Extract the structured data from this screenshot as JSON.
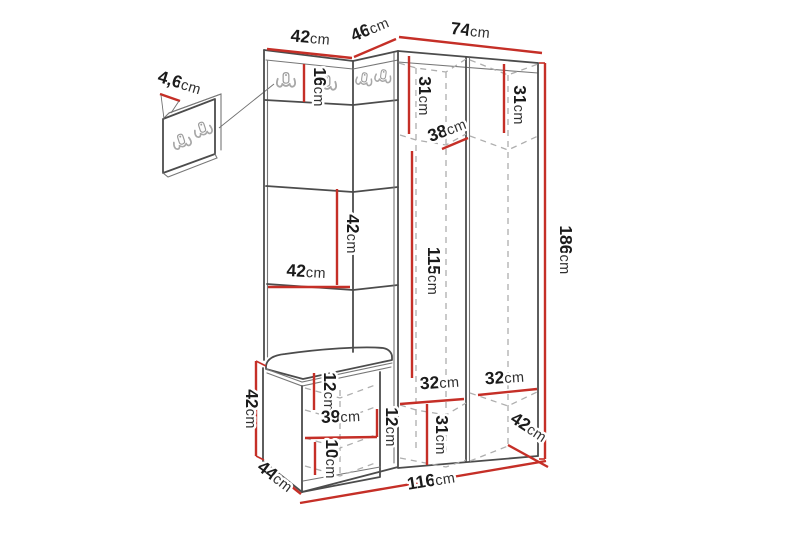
{
  "figure": {
    "kind": "furniture-dimension-diagram",
    "subject": "corner hallway unit with coat hooks, bench and wall hook panel"
  },
  "colors": {
    "background": "#ffffff",
    "dimension_red": "#c52f27",
    "outline": "#4c4c4c",
    "hidden_edge": "#aeaeae",
    "hook_gray": "#a8a8a8",
    "label_text": "#1b1b1b"
  },
  "icons": {
    "hook": "double-coat-hook-icon"
  },
  "dims": {
    "panel_thickness": {
      "num": "4,6",
      "unit": "cm"
    },
    "left_top_width": {
      "num": "42",
      "unit": "cm"
    },
    "corner_top_width": {
      "num": "46",
      "unit": "cm"
    },
    "right_top_width": {
      "num": "74",
      "unit": "cm"
    },
    "hook_panel_height": {
      "num": "16",
      "unit": "cm"
    },
    "left_col_top_height": {
      "num": "31",
      "unit": "cm"
    },
    "right_col_top_height": {
      "num": "31",
      "unit": "cm"
    },
    "top_shelf_depth": {
      "num": "38",
      "unit": "cm"
    },
    "middle_section_height": {
      "num": "42",
      "unit": "cm"
    },
    "middle_section_width": {
      "num": "42",
      "unit": "cm"
    },
    "interior_height": {
      "num": "115",
      "unit": "cm"
    },
    "total_height": {
      "num": "186",
      "unit": "cm"
    },
    "left_col_width": {
      "num": "32",
      "unit": "cm"
    },
    "right_col_width": {
      "num": "32",
      "unit": "cm"
    },
    "bottom_compartment_height": {
      "num": "31",
      "unit": "cm"
    },
    "cabinet_depth": {
      "num": "42",
      "unit": "cm"
    },
    "total_width": {
      "num": "116",
      "unit": "cm"
    },
    "bench_depth": {
      "num": "44",
      "unit": "cm"
    },
    "bench_height": {
      "num": "42",
      "unit": "cm"
    },
    "bench_top_inset": {
      "num": "12",
      "unit": "cm"
    },
    "bench_interior_width": {
      "num": "39",
      "unit": "cm"
    },
    "bench_shelf_spacing": {
      "num": "12",
      "unit": "cm"
    },
    "bench_bottom_height": {
      "num": "10",
      "unit": "cm"
    }
  }
}
